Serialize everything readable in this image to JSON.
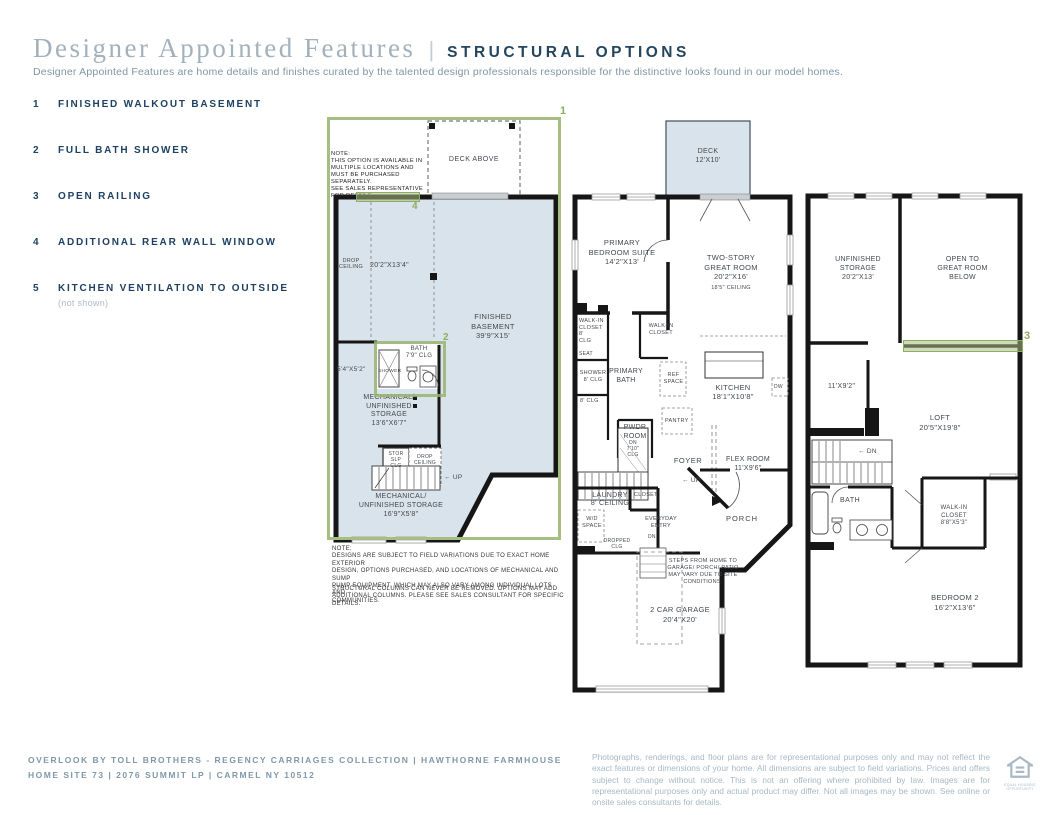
{
  "header": {
    "title": "Designer Appointed Features",
    "separator": "|",
    "subtitle_caps": "STRUCTURAL OPTIONS",
    "description": "Designer Appointed Features are home details and finishes curated by the talented design professionals responsible for the distinctive looks found in our model homes."
  },
  "options": [
    {
      "num": "1",
      "label": "FINISHED WALKOUT BASEMENT"
    },
    {
      "num": "2",
      "label": "FULL BATH SHOWER"
    },
    {
      "num": "3",
      "label": "OPEN RAILING"
    },
    {
      "num": "4",
      "label": "ADDITIONAL REAR WALL WINDOW"
    },
    {
      "num": "5",
      "label": "KITCHEN VENTILATION TO OUTSIDE",
      "note": "(not shown)"
    }
  ],
  "markers": {
    "m1": "1",
    "m2": "2",
    "m3": "3",
    "m4": "4"
  },
  "basement": {
    "option_note": "NOTE:\nTHIS OPTION IS AVAILABLE IN\nMULTIPLE LOCATIONS AND\nMUST BE PURCHASED SEPARATELY.\nSEE SALES REPRESENTATIVE\nFOR DETAILS.",
    "deck_above": "DECK ABOVE",
    "drop_ceiling": "DROP\nCEILING",
    "room_dim": "20'2\"X13'4\"",
    "finished": "FINISHED\nBASEMENT\n39'9\"X15'",
    "bath": "BATH\n7'9\" CLG",
    "shower": "SHOWER",
    "bath_dim": "5'4\"X5'2\"",
    "mech_storage_1": "MECHANICAL/\nUNFINISHED\nSTORAGE\n13'6\"X6'7\"",
    "stor_slp_clg": "STOR\nSLP\nCLG",
    "drop_ceiling_2": "DROP\nCEILING",
    "up": "← UP",
    "mech_storage_2": "MECHANICAL/\nUNFINISHED STORAGE\n16'9\"X5'8\"",
    "field_note": "NOTE:\nDESIGNS ARE SUBJECT TO FIELD VARIATIONS DUE TO EXACT HOME EXTERIOR\nDESIGN, OPTIONS PURCHASED, AND LOCATIONS OF MECHANICAL AND SUMP\nPUMP EQUIPMENT, WHICH MAY ALSO VARY AMONG INDIVIDUAL LOTS AND\nCOMMUNITIES.",
    "columns_note": "STRUCTURAL COLUMNS CAN NEVER BE REMOVED. OPTIONS MAY ADD\nADDITIONAL COLUMNS. PLEASE SEE SALES CONSULTANT FOR SPECIFIC DETAILS."
  },
  "first_floor": {
    "deck": "DECK\n12'X10'",
    "primary_bedroom": "PRIMARY\nBEDROOM SUITE\n14'2\"X13'",
    "great_room": "TWO-STORY\nGREAT ROOM\n20'2\"X16'",
    "great_room_ceiling": "18'5\" CEILING",
    "wic_left": "WALK-IN\nCLOSET\n8'\nCLG",
    "wic_right": "WALK-IN\nCLOSET",
    "seat": "SEAT",
    "shower": "SHOWER\n8' CLG",
    "primary_bath": "PRIMARY\nBATH",
    "wc_clg": "8' CLG",
    "ref_space": "REF\nSPACE",
    "kitchen": "KITCHEN\n18'1\"X10'8\"",
    "dw": "DW",
    "pantry": "PANTRY",
    "pwdr": "PWDR\nROOM",
    "stair_dn": "DN\n7'10\"\nCLG",
    "foyer": "FOYER",
    "flex": "FLEX ROOM\n11'X9'6\"",
    "up": "← UP",
    "laundry": "LAUNDRY\n8' CEILING",
    "wd_space": "W/D\nSPACE",
    "closet": "CLOSET",
    "everyday_entry": "EVERYDAY\nENTRY",
    "dn2": "DN",
    "dropped_clg": "DROPPED\nCLG",
    "porch": "PORCH",
    "steps_note": "STEPS FROM HOME TO\nGARAGE/ PORCH/ PATIO\nMAY VARY DUE TO SITE\nCONDITIONS.",
    "garage": "2 CAR GARAGE\n20'4\"X20'"
  },
  "second_floor": {
    "unfinished_storage": "UNFINISHED\nSTORAGE\n20'2\"X13'",
    "open_below": "OPEN TO\nGREAT ROOM\nBELOW",
    "small_dim": "11'X9'2\"",
    "loft": "LOFT\n20'5\"X19'8\"",
    "dn": "← DN",
    "bath": "BATH",
    "wic": "WALK-IN\nCLOSET\n8'8\"X5'3\"",
    "bedroom2": "BEDROOM 2\n16'2\"X13'6\""
  },
  "footer": {
    "line1": "OVERLOOK BY TOLL BROTHERS - REGENCY CARRIAGES COLLECTION | HAWTHORNE FARMHOUSE",
    "line2": "HOME SITE 73 | 2076 SUMMIT LP | CARMEL NY 10512",
    "disclaimer": "Photographs, renderings, and floor plans are for representational purposes only and may not reflect the exact features or dimensions of your home. All dimensions are subject to field variations. Prices and offers subject to change without notice. This is not an offering where prohibited by law. Images are for representational purposes only and actual product may differ. Not all images may be shown. See online or onsite sales consultants for details.",
    "eho_caption": "EQUAL HOUSING\nOPPORTUNITY"
  },
  "colors": {
    "accent_green": "#a6be82",
    "navy": "#1e4163",
    "room_fill": "#d9e3eb"
  }
}
